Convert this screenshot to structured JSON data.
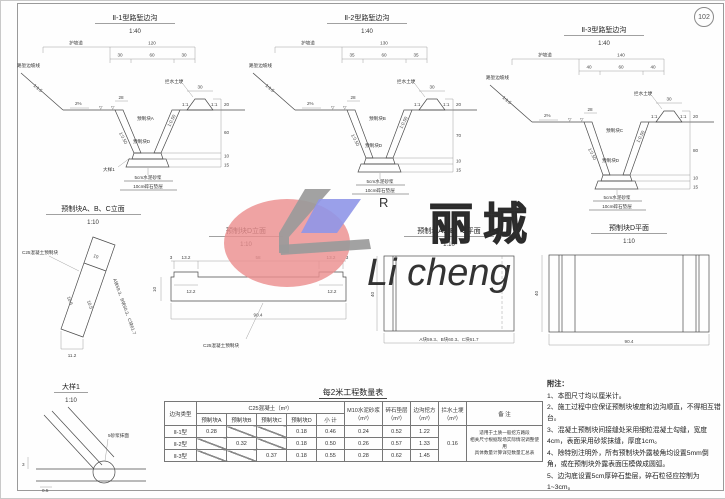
{
  "page": {
    "number": "102"
  },
  "logo": {
    "r": "R",
    "cn": "丽城",
    "en": "Li cheng"
  },
  "xsections": [
    {
      "title": "Ⅱ-1型路堑边沟",
      "scale": "1:40",
      "berm": "护坡道",
      "total": "120",
      "w1": "30",
      "w2": "60",
      "w3": "30",
      "slope_line": "路堑边坡线",
      "cut_slope": "1:1.5",
      "grade": "2%",
      "wall_top": "28",
      "wall_slope_left": "1:0.50",
      "wall_slope_right": "1:0.50",
      "block_wall": "预制块A",
      "block_bottom": "预制块D",
      "mound_label": "拦水土埂",
      "mound_w": "30",
      "mound_slope_left": "1:1",
      "mound_slope_right": "1:1",
      "h_mound": "20",
      "h_depth": "60",
      "h_slab": "10",
      "h_cushion": "15",
      "note1": "5cm水泥砂浆",
      "note2": "10cm碎石垫层",
      "detail_ref": "大样1"
    },
    {
      "title": "Ⅱ-2型路堑边沟",
      "scale": "1:40",
      "berm": "护坡道",
      "total": "130",
      "w1": "35",
      "w2": "60",
      "w3": "35",
      "slope_line": "路堑边坡线",
      "cut_slope": "1:1.5",
      "grade": "2%",
      "wall_top": "28",
      "wall_slope_left": "1:0.50",
      "wall_slope_right": "1:0.50",
      "block_wall": "预制块B",
      "block_bottom": "预制块D",
      "mound_label": "拦水土埂",
      "mound_w": "30",
      "mound_slope_left": "1:1",
      "mound_slope_right": "1:1",
      "h_mound": "20",
      "h_depth": "70",
      "h_slab": "10",
      "h_cushion": "15",
      "note1": "5cm水泥砂浆",
      "note2": "10cm碎石垫层"
    },
    {
      "title": "Ⅱ-3型路堑边沟",
      "scale": "1:40",
      "berm": "护坡道",
      "total": "140",
      "w1": "40",
      "w2": "60",
      "w3": "40",
      "slope_line": "路堑边坡线",
      "cut_slope": "1:1.5",
      "grade": "2%",
      "wall_top": "28",
      "wall_slope_left": "1:0.50",
      "wall_slope_right": "1:0.50",
      "block_wall": "预制块C",
      "block_bottom": "预制块D",
      "mound_label": "拦水土埂",
      "mound_w": "30",
      "mound_slope_left": "1:1",
      "mound_slope_right": "1:1",
      "h_mound": "20",
      "h_depth": "80",
      "h_slab": "10",
      "h_cushion": "15",
      "note1": "5cm水泥砂浆",
      "note2": "10cm碎石垫层"
    }
  ],
  "blocks": {
    "abc_elev": {
      "title": "预制块A、B、C立面",
      "scale": "1:10",
      "material": "C25混凝土预制块",
      "w_top": "10",
      "seg1": "10.5",
      "seg2": "10.5",
      "w_bottom": "11.2",
      "slant": "A块59.3、B块60.3、C块61.7"
    },
    "d_elev": {
      "title": "预制块D立面",
      "scale": "1:10",
      "material": "C25混凝土预制块",
      "edge_l": "3",
      "lip_l": "13.2",
      "mid": "58",
      "lip_r": "13.2",
      "edge_r": "3",
      "recess_l": "12.2",
      "recess_r": "12.2",
      "height": "10",
      "total": "90.4"
    },
    "abc_plan": {
      "title": "预制块A、B、C平面",
      "scale": "1:10",
      "height": "40",
      "lengths": "A块59.3、B块60.3、C块61.7"
    },
    "d_plan": {
      "title": "预制块D平面",
      "scale": "1:10",
      "height": "40",
      "total": "90.4"
    }
  },
  "detail1": {
    "title": "大样1",
    "scale": "1:10",
    "note": "5砂浆抹面",
    "dim_v": "3",
    "dim_h": "0.5"
  },
  "qtable": {
    "title": "每2米工程数量表",
    "col_type": "边沟类型",
    "col_concrete": "C25混凝土（m³）",
    "sub": [
      "预制块A",
      "预制块B",
      "预制块C",
      "预制块D",
      "小 计"
    ],
    "col_mortar": "M10水泥砂浆（m³）",
    "col_gravel": "碎石垫层（m³）",
    "col_excavation": "边沟挖方（m³）",
    "col_mound": "拦水土埂（m³）",
    "col_remark": "备 注",
    "rows": [
      {
        "type": "Ⅱ-1型",
        "a": "0.28",
        "d": "0.18",
        "sub": "0.46",
        "mortar": "0.24",
        "gravel": "0.52",
        "exc": "1.22"
      },
      {
        "type": "Ⅱ-2型",
        "b": "0.32",
        "d": "0.18",
        "sub": "0.50",
        "mortar": "0.26",
        "gravel": "0.57",
        "exc": "1.33"
      },
      {
        "type": "Ⅱ-3型",
        "c": "0.37",
        "d": "0.18",
        "sub": "0.55",
        "mortar": "0.28",
        "gravel": "0.62",
        "exc": "1.45"
      }
    ],
    "mound_value": "0.16",
    "remark_lines": [
      "适用于土质一般挖方路段",
      "相关尺寸根据现场实际情况调整使用",
      "具体数量计算详见数量汇总表"
    ]
  },
  "notes": {
    "title": "附注：",
    "items": [
      "1、本图尺寸均以厘米计。",
      "2、施工过程中应保证预制块坡度和边沟顺直，不得相互错台。",
      "3、混凝土预制块间接缝处采用细粒混凝土勾缝，宽度4cm，表面采用砂浆抹缝，厚度1cm。",
      "4、除特别注明外，所有预制块外露棱角均设置5mm倒角，或在预制块外露表面压模做成圆弧。",
      "5、边沟底设置5cm厚碎石垫层，碎石粒径应控制为1~3cm。"
    ]
  }
}
